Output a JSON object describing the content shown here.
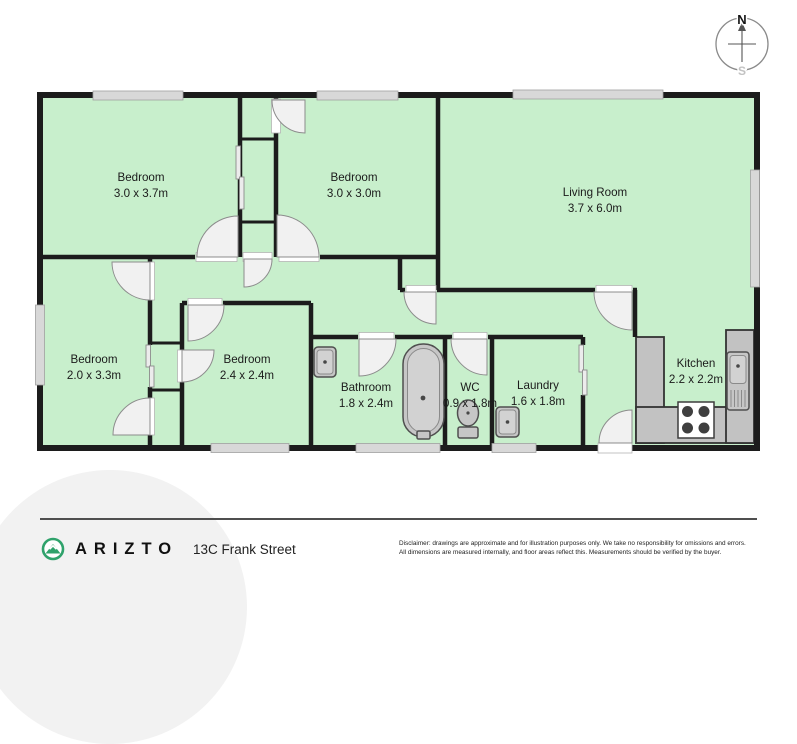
{
  "plan": {
    "rooms": [
      {
        "name": "Bedroom",
        "dims": "3.0 x 3.7m"
      },
      {
        "name": "Bedroom",
        "dims": "3.0 x 3.0m"
      },
      {
        "name": "Living Room",
        "dims": "3.7 x 6.0m"
      },
      {
        "name": "Bedroom",
        "dims": "2.0 x 3.3m"
      },
      {
        "name": "Bedroom",
        "dims": "2.4 x 2.4m"
      },
      {
        "name": "Bathroom",
        "dims": "1.8 x 2.4m"
      },
      {
        "name": "WC",
        "dims": "0.9 x 1.8m"
      },
      {
        "name": "Laundry",
        "dims": "1.6 x 1.8m"
      },
      {
        "name": "Kitchen",
        "dims": "2.2 x 2.2m"
      }
    ],
    "compass": {
      "north": "N",
      "south": "S"
    }
  },
  "footer": {
    "brand": "ARIZTO",
    "address": "13C Frank Street",
    "disclaimer_line1": "Disclaimer: drawings are approximate and for illustration purposes only. We take no responsibility for omissions and errors.",
    "disclaimer_line2": "All dimensions are measured internally, and floor areas reflect this. Measurements should be verified by the buyer."
  },
  "colors": {
    "room-fill": "#c8efcc",
    "wall": "#1c1c1c",
    "window-fill": "#d8d8d8",
    "door-fill": "#f1f1f1",
    "fixture-fill": "#c6c6c6",
    "counter-fill": "#c2c2c2",
    "brand-green": "#2fa26b",
    "bg-circle": "#f2f2f2"
  }
}
